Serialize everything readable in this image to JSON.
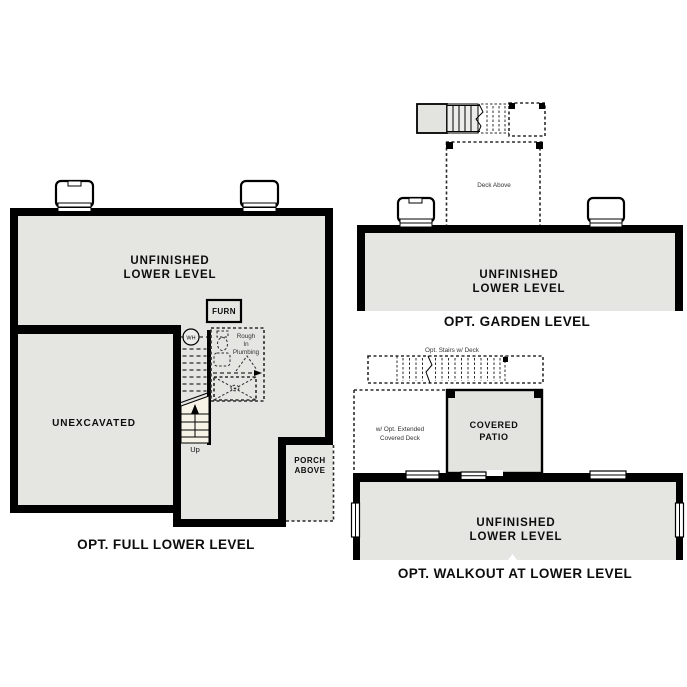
{
  "colors": {
    "wall": "#000000",
    "room_fill": "#e5e5e2",
    "stair_fill": "#f7f3e7",
    "dash": "#2b2b2b",
    "bg": "#ffffff"
  },
  "plans": {
    "full_lower": {
      "title": "OPT. FULL LOWER LEVEL",
      "unfinished_line1": "UNFINISHED",
      "unfinished_line2": "LOWER LEVEL",
      "unexcavated": "UNEXCAVATED",
      "furnace": "FURN",
      "water_heater": "WH",
      "rough_in_line1": "Rough",
      "rough_in_line2": "In",
      "rough_in_line3": "Plumbing",
      "stairs_up": "Up",
      "porch_line1": "PORCH",
      "porch_line2": "ABOVE"
    },
    "garden": {
      "title": "OPT. GARDEN LEVEL",
      "unfinished_line1": "UNFINISHED",
      "unfinished_line2": "LOWER LEVEL",
      "deck_above": "Deck Above"
    },
    "walkout": {
      "title": "OPT. WALKOUT AT LOWER LEVEL",
      "unfinished_line1": "UNFINISHED",
      "unfinished_line2": "LOWER LEVEL",
      "covered_patio_line1": "COVERED",
      "covered_patio_line2": "PATIO",
      "ext_deck_line1": "w/ Opt. Extended",
      "ext_deck_line2": "Covered Deck",
      "stairs_label": "Opt. Stairs w/ Deck"
    }
  }
}
